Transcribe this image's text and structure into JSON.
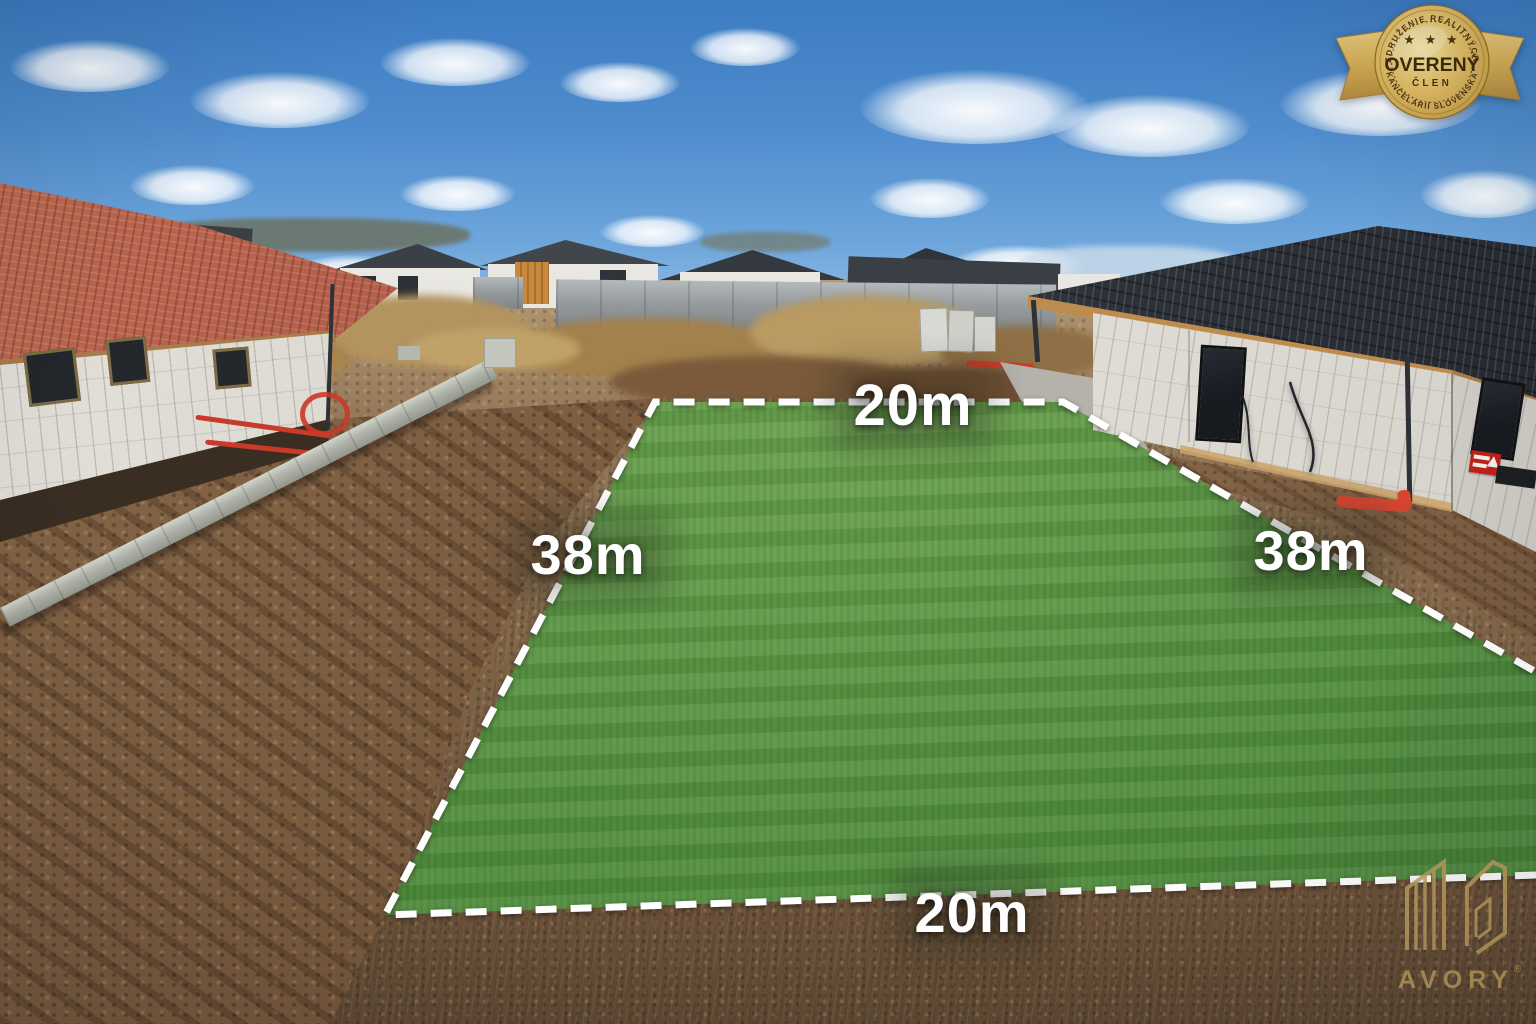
{
  "plot": {
    "top_label": "20m",
    "right_label": "38m",
    "bottom_label": "20m",
    "left_label": "38m",
    "outline_color": "#ffffff"
  },
  "badge": {
    "arc_top": "ZDRUŽENIE REALITNÝCH",
    "title": "OVERENÝ",
    "subtitle": "ČLEN",
    "arc_bottom": "KANCELÁRIÍ SLOVENSKA",
    "stars": "★ ★ ★",
    "gold_color": "#d9b659",
    "text_color": "#42320f"
  },
  "watermark": {
    "brand": "AVORY",
    "registered": "®",
    "color": "#bfa05f"
  },
  "colors": {
    "sky": "#4d8ccb",
    "plot_grass": "#55923e",
    "soil": "#7c5d40",
    "outline": "#ffffff"
  }
}
